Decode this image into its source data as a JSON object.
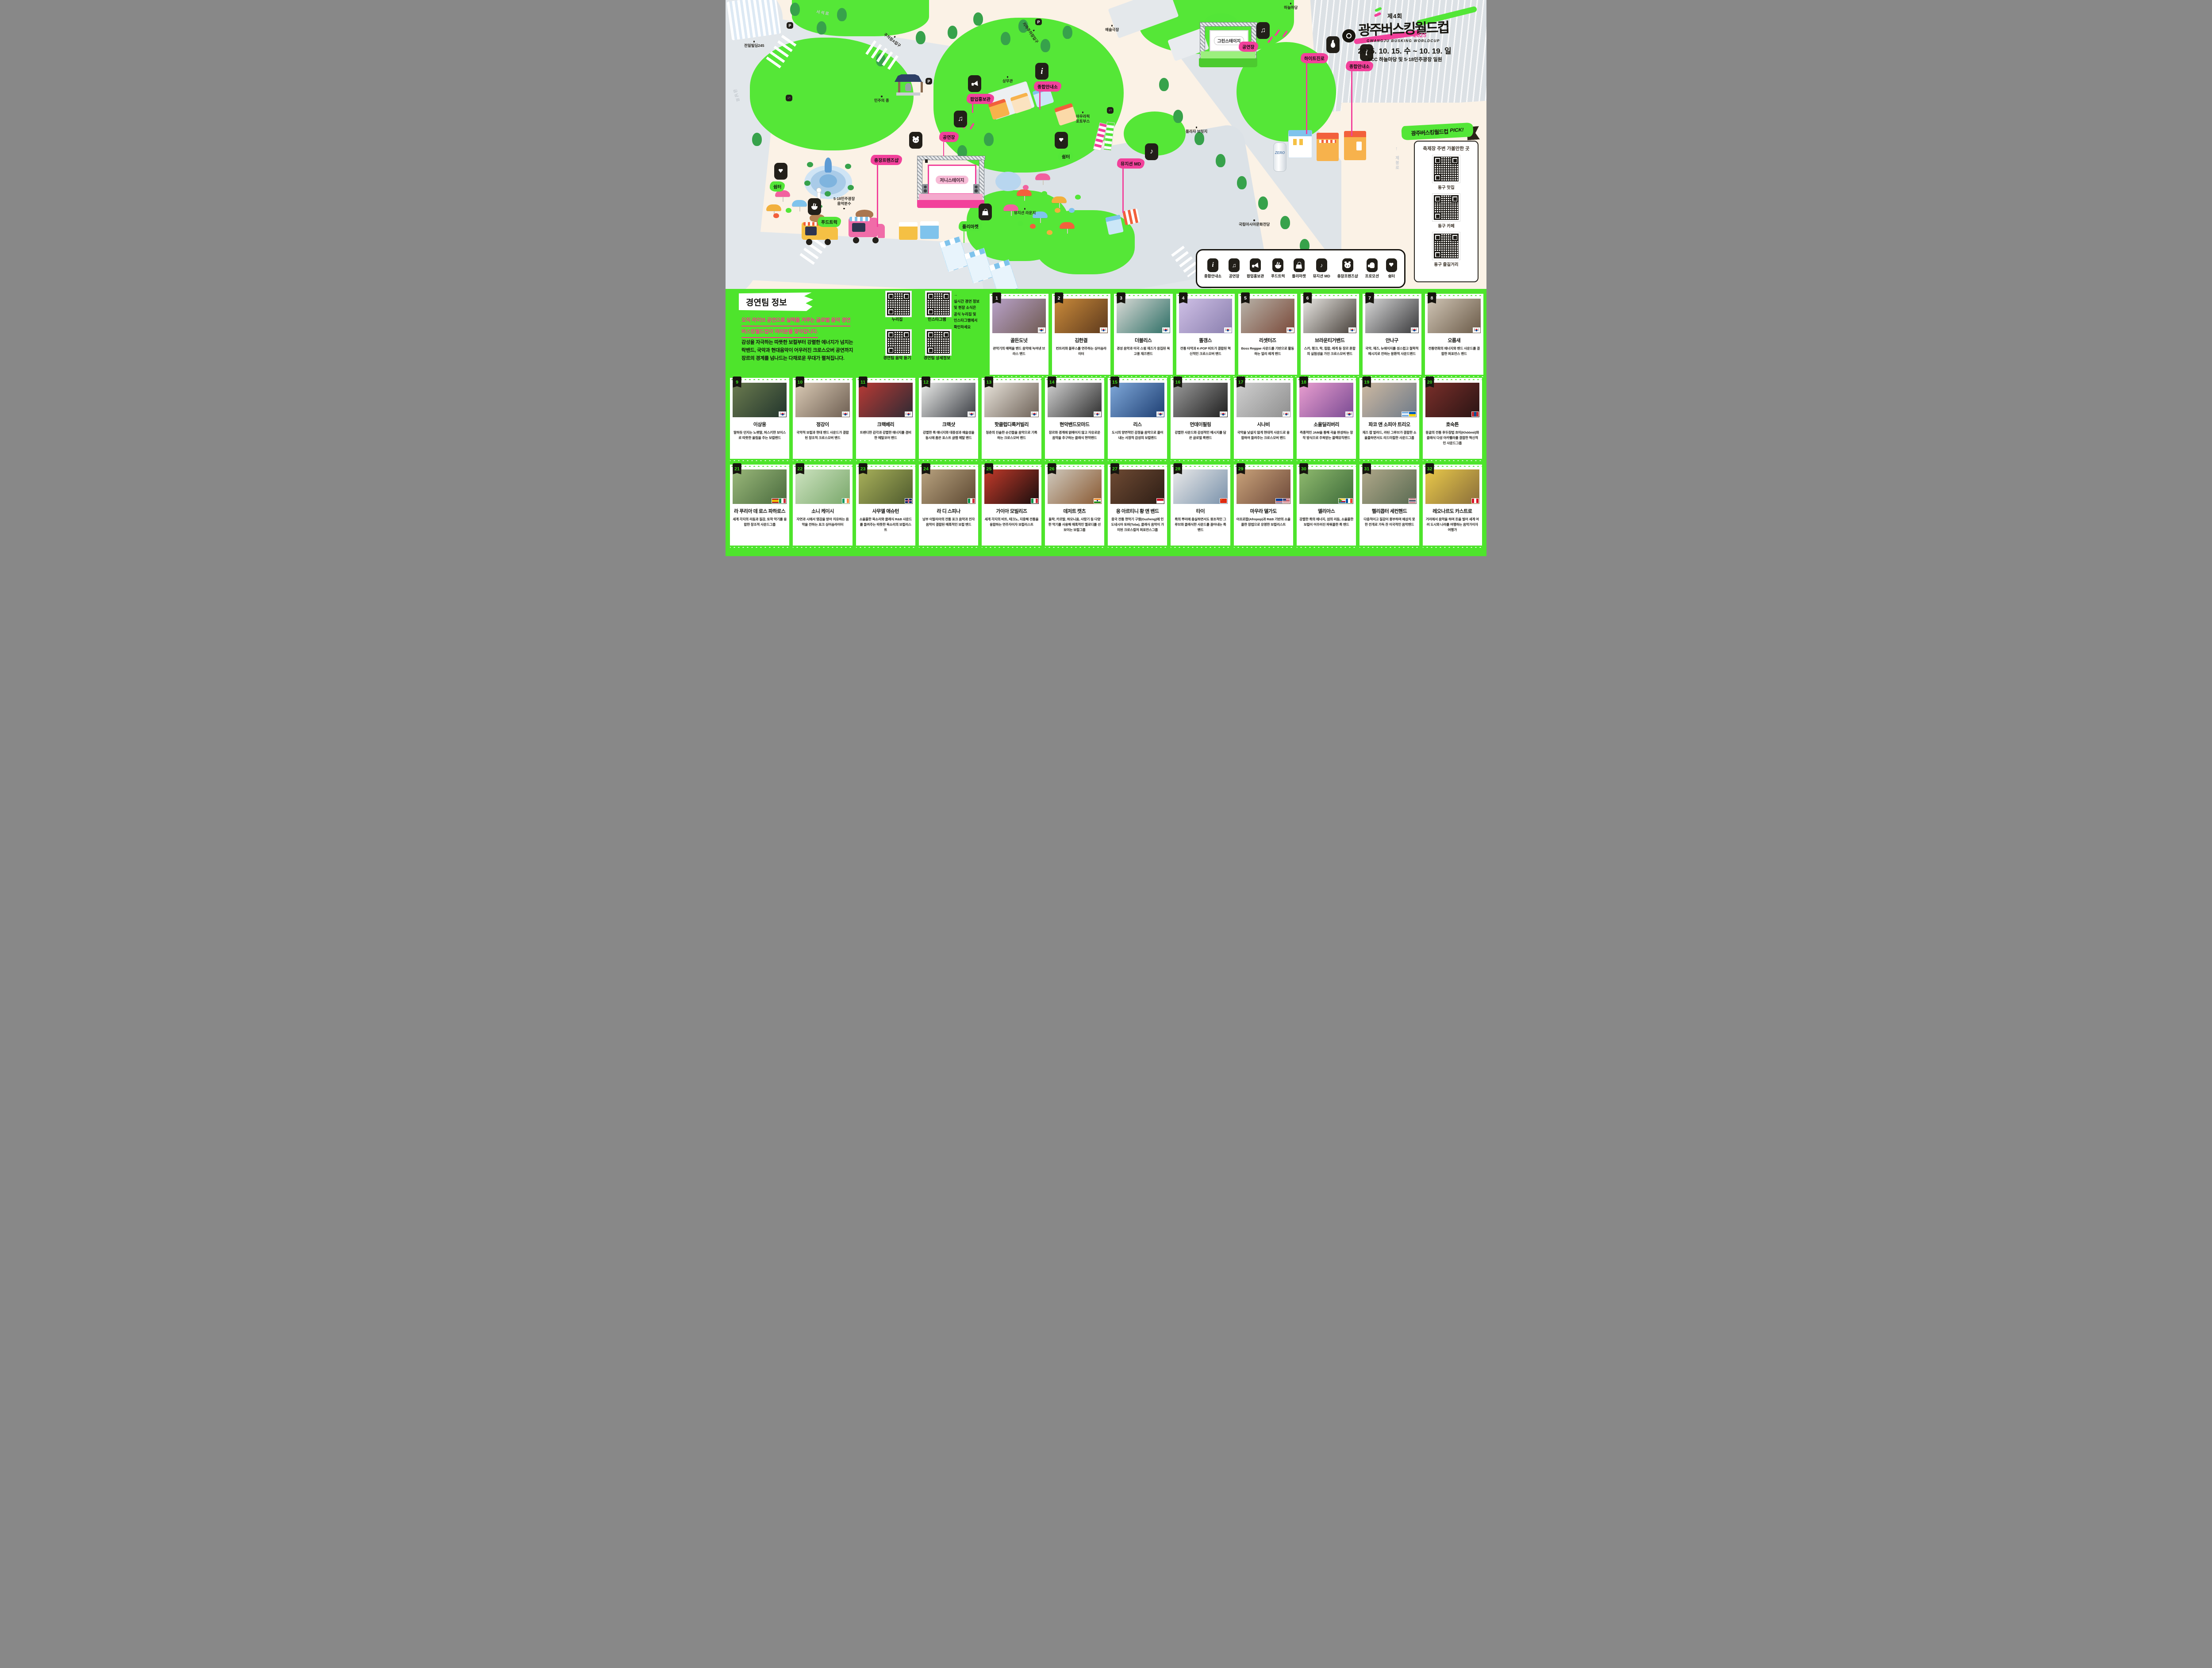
{
  "event": {
    "edition": "제4회",
    "title": "광주버스킹월드컵",
    "title_en": "GWANGJU BUSKING WORLDCUP",
    "year": "2025",
    "dates": "2025. 10. 15. 수 ~ 10. 19. 일",
    "venue": "ACC 하늘마당 및 5·18민주광장 일원"
  },
  "map": {
    "stage_main": "저니스테이지",
    "stage_green": "그린스테이지",
    "beer_label": "ZERO",
    "flags": {
      "stage_left": "공연장",
      "stage_right": "공연장",
      "popup": "팝업홍보관",
      "info_left": "종합안내소",
      "info_right": "종합안내소",
      "hite": "하이트진로",
      "md": "뮤지션 MD",
      "friends": "충장프렌즈샵",
      "shelter_left": "쉼터",
      "shelter_center": "쉼터",
      "foodtruck": "푸드트럭",
      "fleamarket": "플리마켓"
    },
    "poi": {
      "jeonil": "전일빌딩245",
      "bell": "민주의 종",
      "fountain": "5·18민주광장\n음악분수",
      "sangmu": "상무관",
      "theater": "예술극장",
      "sky": "하늘마당",
      "photobooth": "아우라픽\n포토부스",
      "lounge": "뮤지션 라운지",
      "plaza_bridge": "플라자 브릿지",
      "acc": "국립아시아문화전당",
      "parking_under": "지하주차장입구",
      "parking_a": "주차장A입구"
    },
    "streets": {
      "seoseok": "서석로",
      "geumnam": "금남로",
      "jebong": "제봉로"
    },
    "legend": [
      {
        "icon": "info",
        "label": "종합안내소"
      },
      {
        "icon": "note",
        "label": "공연장"
      },
      {
        "icon": "mega",
        "label": "팝업홍보관"
      },
      {
        "icon": "bowl",
        "label": "푸드트럭"
      },
      {
        "icon": "bag",
        "label": "플리마켓"
      },
      {
        "icon": "md",
        "label": "뮤지션 MD"
      },
      {
        "icon": "tiger",
        "label": "충장프렌즈샵"
      },
      {
        "icon": "hand",
        "label": "프로모션"
      },
      {
        "icon": "flower",
        "label": "쉼터"
      }
    ]
  },
  "pick": {
    "ribbon": "광주버스킹월드컵",
    "pick": "PICK!",
    "title": "축제장 주변 가볼만한 곳",
    "items": [
      "동구 맛집",
      "동구 카페",
      "동구 즐길거리"
    ]
  },
  "teams_section": {
    "flag_title": "경연팀 정보",
    "headline1": "오직 라이브 공연으로 실력을 겨루는 글로벌 음악 경연",
    "headline2": "버스킹월드컵이 여러분을 찾아갑니다.",
    "body": "감성을 자극하는 따뜻한 보컬부터 강렬한 에너지가 넘치는\n락밴드, 국악과 현대음악이 어우러진 크로스오버 공연까지\n장르의 경계를 넘나드는 다채로운 무대가 펼쳐집니다.",
    "qr_labels": [
      "누리집",
      "인스타그램",
      "경연팀 음악 듣기",
      "경연팀 상세정보"
    ],
    "qr_note": "→\n실시간 경연 정보\n및 현장 소식은\n공식 누리집 및\n인스타그램에서\n확인하세요"
  },
  "accent_colors": {
    "pink": "#F2419B",
    "green": "#4EE42C",
    "black": "#17150f",
    "cream": "#FBF2E6"
  },
  "teams": [
    {
      "num": 1,
      "name": "골든도넛",
      "desc": "관악기의 매력을 밴드 음악에 녹여낸 브라스 밴드",
      "flags": [
        "kr"
      ],
      "photo": [
        "#b9a2c9",
        "#6f5a52"
      ]
    },
    {
      "num": 2,
      "name": "김한결",
      "desc": "컨트리와 블루스를 연주하는 싱어송라이터",
      "flags": [
        "kr"
      ],
      "photo": [
        "#c98a3a",
        "#5e3a1d"
      ]
    },
    {
      "num": 3,
      "name": "더블리스",
      "desc": "경성 음악과 미국 스윙 재즈가 응집된 복고풍 재즈밴드",
      "flags": [
        "kr"
      ],
      "photo": [
        "#d9dad6",
        "#2e6f66"
      ]
    },
    {
      "num": 4,
      "name": "똘갱스",
      "desc": "전통 타악과 K-POP 비트가 결합된 혁신적인 크로스오버 밴드",
      "flags": [
        "kr"
      ],
      "photo": [
        "#cfc0e6",
        "#8a7fae"
      ]
    },
    {
      "num": 5,
      "name": "리셋터즈",
      "desc": "Boss Reggae 사운드를 기반으로 활동하는 얼리 레게 밴드",
      "flags": [
        "kr"
      ],
      "photo": [
        "#b8b2a8",
        "#7a4a3a"
      ]
    },
    {
      "num": 6,
      "name": "브라운티거밴드",
      "desc": "스카, 펑크, 락, 힙합, 레게 등 장르 혼합의 실험성을 가진 크로스오버 밴드",
      "flags": [
        "kr"
      ],
      "photo": [
        "#e8e6e2",
        "#47403a"
      ]
    },
    {
      "num": 7,
      "name": "안나구",
      "desc": "국악, 재즈, 뉴에이지를 성스럽고 철학적 메시지로 전하는 몽환적 사운드밴드",
      "flags": [
        "kr"
      ],
      "photo": [
        "#d8d8d8",
        "#3a3a3c"
      ]
    },
    {
      "num": 8,
      "name": "오름새",
      "desc": "전통연희의 에너지와 밴드 사운드를 결합한 퍼포먼스 밴드",
      "flags": [
        "kr"
      ],
      "photo": [
        "#cfc4b4",
        "#6b5b49"
      ]
    },
    {
      "num": 9,
      "name": "이상웅",
      "desc": "말하듯 던지는 노랫말, 허스키한 보이스로 따뜻한 울림을 주는 보컬밴드",
      "flags": [
        "kr"
      ],
      "photo": [
        "#6b7b4f",
        "#22352c"
      ]
    },
    {
      "num": 10,
      "name": "정강이",
      "desc": "국악적 보컬과 현대 밴드 사운드가 결합된 창조적 크로스오버 밴드",
      "flags": [
        "kr"
      ],
      "photo": [
        "#d9c9b4",
        "#6e5f52"
      ]
    },
    {
      "num": 11,
      "name": "크랙베리",
      "desc": "트렌디한 감각과 강렬한 에너지를 겸비한 메탈코어 밴드",
      "flags": [
        "kr"
      ],
      "photo": [
        "#b83a35",
        "#2e2a33"
      ]
    },
    {
      "num": 12,
      "name": "크랙샷",
      "desc": "강렬한 록 에너지와 대중성과 예술성을 동시에 품은 포스트 글램 메탈 밴드",
      "flags": [
        "kr"
      ],
      "photo": [
        "#e9eae8",
        "#3c3f45"
      ]
    },
    {
      "num": 13,
      "name": "핫클럽디록커빌리",
      "desc": "청춘의 진솔한 순간들을 음악으로 기록하는 크로스오버 밴드",
      "flags": [
        "kr"
      ],
      "photo": [
        "#e8e3da",
        "#6e6258"
      ]
    },
    {
      "num": 14,
      "name": "현악밴드모마드",
      "desc": "장르와 경계에 얽매이지 않고 자유로운 음악을 추구하는 클래식 현악밴드",
      "flags": [
        "kr"
      ],
      "photo": [
        "#cfcfcf",
        "#2f2f2f"
      ]
    },
    {
      "num": 15,
      "name": "리스",
      "desc": "도시의 양면적인 감정을 음악으로 풀어내는 서정적 감성의 보컬밴드",
      "flags": [
        "kr"
      ],
      "photo": [
        "#7fa8d9",
        "#1e3f73"
      ]
    },
    {
      "num": 16,
      "name": "먼데이필링",
      "desc": "강렬한 사운드와 감성적인 메시지를 담은 글로벌 록밴드",
      "flags": [
        "kr"
      ],
      "photo": [
        "#9a9a9a",
        "#1f1f1f"
      ]
    },
    {
      "num": 17,
      "name": "시나비",
      "desc": "국악을 낯설지 않게 현대적 사운드로 융합하여 들려주는 크로스오버 밴드",
      "flags": [
        "kr"
      ],
      "photo": [
        "#cfcfcf",
        "#8f8f8f"
      ]
    },
    {
      "num": 18,
      "name": "소울딜리버리",
      "desc": "즉흥적인 JAM을 통해 곡을 완성하는 창작 방식으로 주목받는 블랙뮤직밴드",
      "flags": [
        "kr"
      ],
      "photo": [
        "#e99ed0",
        "#7a4b93"
      ]
    },
    {
      "num": 19,
      "name": "파코 앤 소피아 트리오",
      "desc": "재즈 팝 발라드, 라틴 그루브가 결합한 소울풀하면서도 리드미컬한 사운드그룹",
      "flags": [
        "ar",
        "ua"
      ],
      "photo": [
        "#cdb9a2",
        "#6e7a88"
      ]
    },
    {
      "num": 20,
      "name": "호숙튼",
      "desc": "몽골의 전통 후두창법 흐미(Khöömii)와 클래식 다성 아카펠라를 결합한 혁신적인 사운드그룹",
      "flags": [
        "mn"
      ],
      "photo": [
        "#7a2f2a",
        "#2a1414"
      ]
    },
    {
      "num": 21,
      "name": "라 푸리아 데 로스 파하로스",
      "desc": "세계 각지의 리듬과 질감, 토착 악기를 융합한 창조적 사운드그룹",
      "flags": [
        "es",
        "it"
      ],
      "photo": [
        "#9ab87a",
        "#4a6b3e"
      ]
    },
    {
      "num": 22,
      "name": "소니 케이시",
      "desc": "자연과 시에서 영감을 받아 치유하는 음악을 전하는 포크 싱어송라이터",
      "flags": [
        "ie"
      ],
      "photo": [
        "#cde3c0",
        "#7aa86b"
      ]
    },
    {
      "num": 23,
      "name": "사무엘 애슈턴",
      "desc": "소울풀한 목소리와 클래식 R&B 사운드를 들려주는 따뜻한 목소리의 보컬리스트",
      "flags": [
        "gb"
      ],
      "photo": [
        "#a8b05a",
        "#4f5b2e"
      ]
    },
    {
      "num": 24,
      "name": "라 디 스피나",
      "desc": "남부 이탈리아의 전통 포크 음악과 전자음악이 결합된 매혹적인 보컬 밴드",
      "flags": [
        "it"
      ],
      "photo": [
        "#b8a27f",
        "#5e4a33"
      ]
    },
    {
      "num": 25,
      "name": "가이아 모빌리즈",
      "desc": "세계 각지의 비트, 테크노, 지중해 전통을 융합하는 연주자이자 보컬리스트",
      "flags": [
        "it"
      ],
      "photo": [
        "#c23a2a",
        "#1a0e0e"
      ]
    },
    {
      "num": 26,
      "name": "데저트 캣츠",
      "desc": "돌락, 카르탈, 하모니움, 사랑기 등 다양한 악기를 사용해 매혹적인 멜로디를 선보이는 보컬그룹",
      "flags": [
        "in"
      ],
      "photo": [
        "#cfc9bd",
        "#8a5a33"
      ]
    },
    {
      "num": 27,
      "name": "응 아르티니 황 앤 밴드",
      "desc": "중국 전통 현악기 구쟁(Guzheng)에 인도네시아 토바(Toba), 클래식 음악이 가미된 크로스컬처 퍼포먼스그룹",
      "flags": [
        "id"
      ],
      "photo": [
        "#6e4a33",
        "#2e1e16"
      ]
    },
    {
      "num": 28,
      "name": "타이",
      "desc": "록의 뿌리에 충실하면서도 원초적인 그루브와 클래식한 사운드를 끌어내는 록밴드",
      "flags": [
        "cn"
      ],
      "photo": [
        "#e9e9e9",
        "#7a92ab"
      ]
    },
    {
      "num": 29,
      "name": "마우라 델가도",
      "desc": "아프로팝(Afropop)과 R&B 기반의 소울풀한 창법으로 유명한 보컬리스트",
      "flags": [
        "cv",
        "us"
      ],
      "photo": [
        "#c9a27a",
        "#6e4a3a"
      ]
    },
    {
      "num": 30,
      "name": "엘리아스",
      "desc": "강렬한 록의 에너지, 섬의 리듬, 소울풀한 보컬이 어우러진 파워풀한 록 밴드",
      "flags": [
        "km",
        "fr"
      ],
      "photo": [
        "#8fba6e",
        "#3e6b3a"
      ]
    },
    {
      "num": 31,
      "name": "헬리콥터 세컨핸드",
      "desc": "다층적이고 질감이 풍부하며 예상치 못한 전개로 가득 찬 이국적인 음악밴드",
      "flags": [
        "th"
      ],
      "photo": [
        "#b0a88a",
        "#5a6b52"
      ]
    },
    {
      "num": 32,
      "name": "레오나르도 카스트로",
      "desc": "거리에서 음악을 하며 돈을 벌어 세계 여러 도시와 나라를 여행하는 음악가이자 여행가",
      "flags": [
        "pe"
      ],
      "photo": [
        "#e9c94a",
        "#8a6e3a"
      ]
    }
  ]
}
